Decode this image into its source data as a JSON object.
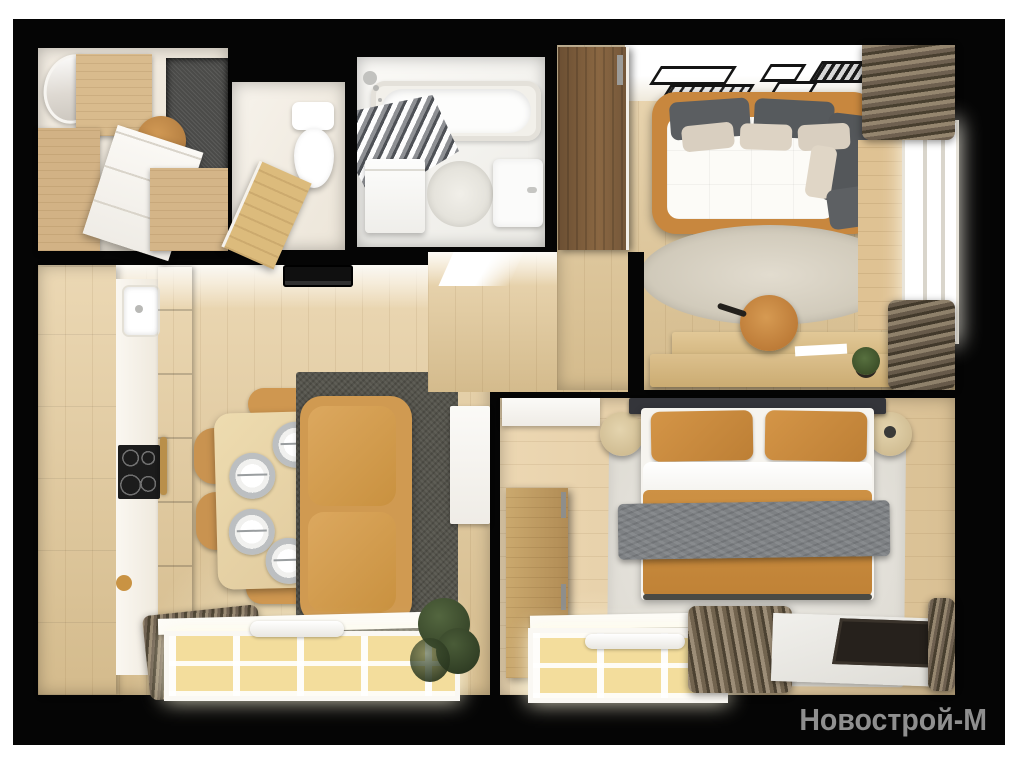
{
  "watermark": {
    "text": "Новострой-М",
    "color": "#8f8f8f"
  },
  "palette": {
    "canvas_background": "#050505",
    "page_margin": "#ffffff",
    "wood_floor": "#e4c997",
    "wood_furniture": "#d2b285",
    "walnut_wardrobe": "#7a5c3c",
    "accent_caramel": "#c8873e",
    "textile_dark_gray": "#5b5e61",
    "textile_beige": "#d9cfc0",
    "curtain_brown": "#6e6050",
    "rug_dark": "#55544c",
    "rug_light": "#ddd7ca",
    "white_furniture": "#f7f5f1",
    "window_light": "#f3dd9c",
    "watermark_gray": "#8f8f8f"
  },
  "rooms": [
    {
      "name": "hallway",
      "furniture": [
        "mirror",
        "wardrobe",
        "chest-of-drawers",
        "pouf",
        "gray-rug"
      ]
    },
    {
      "name": "wc",
      "furniture": [
        "toilet",
        "wood-door"
      ]
    },
    {
      "name": "bathroom",
      "furniture": [
        "bathtub",
        "shower-curtain",
        "shower-head",
        "washing-machine",
        "round-mat",
        "sink"
      ]
    },
    {
      "name": "living-office",
      "furniture": [
        "walnut-wardrobe",
        "wall-shelves",
        "floor-lamp",
        "sofa-daybed",
        "pillows",
        "round-rug",
        "desk",
        "office-chair",
        "paper",
        "plant",
        "window",
        "curtains"
      ]
    },
    {
      "name": "corridor",
      "furniture": [
        "doorway"
      ]
    },
    {
      "name": "kitchen-living",
      "furniture": [
        "ceiling-light",
        "kitchen-cabinets",
        "kitchen-sink",
        "cooktop",
        "oven-handle",
        "dining-table",
        "plates",
        "chairs",
        "sofa",
        "dark-rug",
        "tv-console",
        "window",
        "radiator",
        "curtains",
        "plant"
      ]
    },
    {
      "name": "bedroom",
      "furniture": [
        "double-bed",
        "pillows",
        "duvet",
        "throw-blanket",
        "nightstands",
        "dresser",
        "wardrobe",
        "light-rug",
        "window",
        "radiator",
        "curtains",
        "floor-mat"
      ]
    }
  ]
}
